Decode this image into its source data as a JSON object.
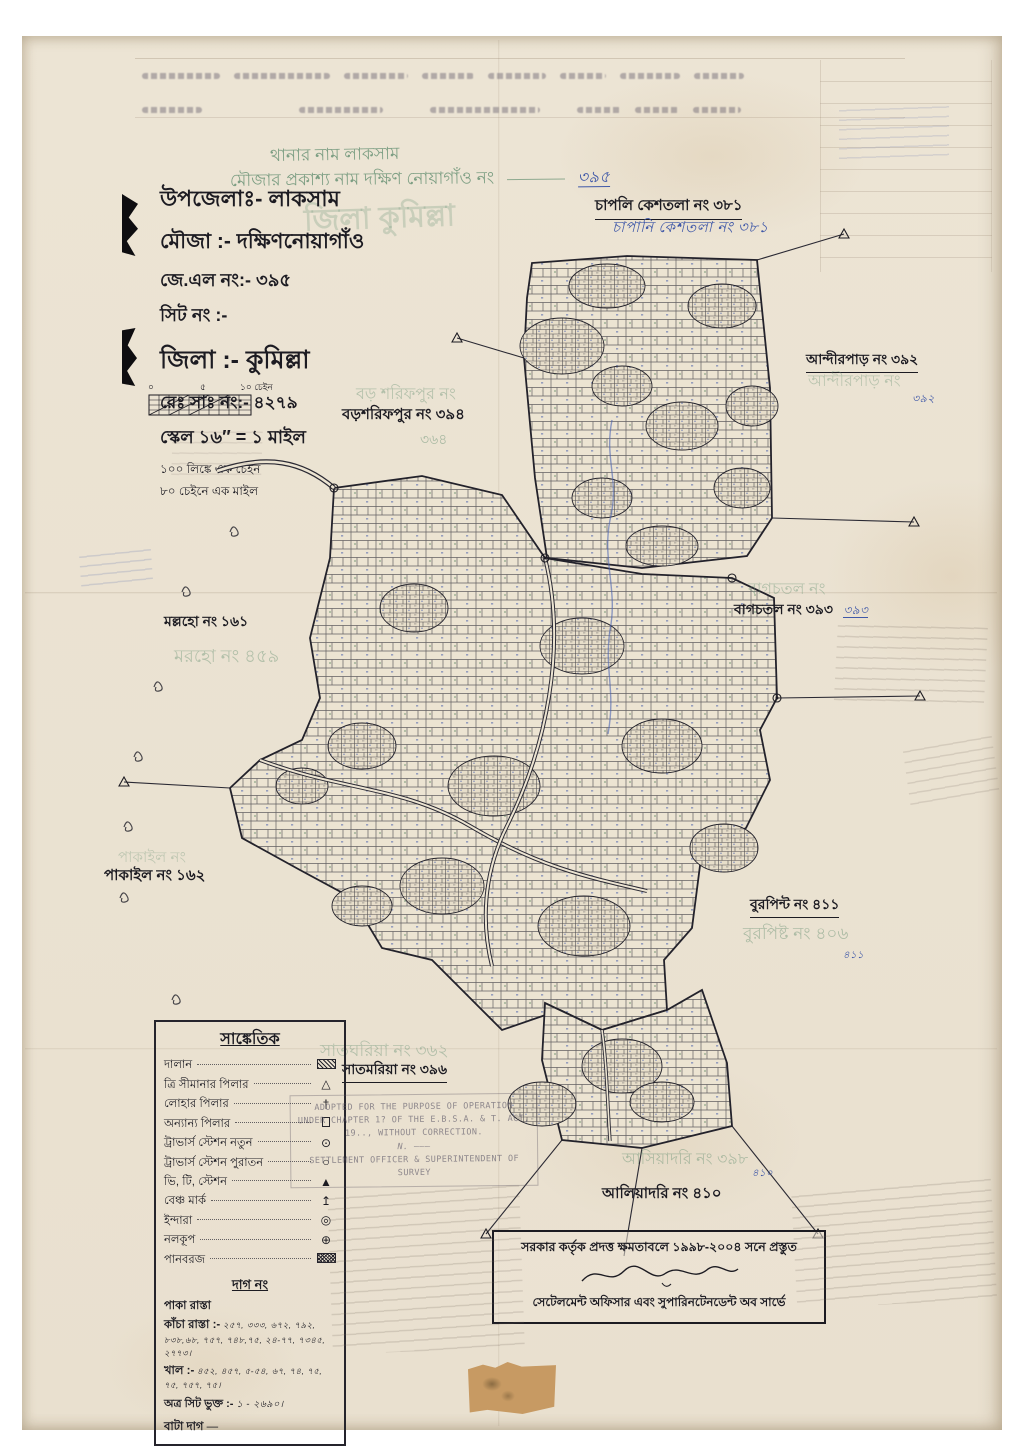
{
  "colors": {
    "ink": "#1c1b22",
    "pencil_green": "#689274",
    "pen_blue": "#3f58a8",
    "paper": "#ece4d4"
  },
  "pencil_top": {
    "line1": "থানার নাম  লাকসাম",
    "line2": "মৌজার প্রকাশ্য নাম  দক্ষিণ নোয়াগাঁও  নং",
    "number": "৩৯৫",
    "ghost": "জিলা  কুমিল্লা"
  },
  "header": {
    "upazila": "উপজেলাঃ- লাকসাম",
    "mouza": "মৌজা :- দক্ষিণনোয়াগাঁও",
    "jl_no": "জে.এল নং:- ৩৯৫",
    "sheet_no": "সিট নং :-",
    "zila": "জিলা :- কুমিল্লা",
    "reg_no": "রেঃ সাঃ নং:- ৪২৭৯",
    "scale": "স্কেল ১৬″ = ১ মাইল",
    "note1": "১০০ লিঙ্কে এক চেইন",
    "note2": "৮০ চেইনে এক মাইল",
    "scalebar": {
      "t0": "০",
      "t5": "৫",
      "t10": "১০ চেইন"
    }
  },
  "regions": [
    {
      "ink": "চাপলি কেশতলা নং ৩৮১",
      "blue": "চাপানি কেশতলা নং  ৩৮১"
    },
    {
      "ink": "আন্দীরপাড় নং ৩৯২",
      "pencil": "আন্দীরপাড় নং",
      "blue": "৩৯২"
    },
    {
      "ink": "মল্লহো নং ১৬১",
      "pencil": "মরহো নং ৪৫৯"
    },
    {
      "pencil": "বাগচতল নং",
      "ink": "বাগচতল নং ৩৯৩",
      "blue": "৩৯৩"
    },
    {
      "pencil": "বড় শরিফপুর নং",
      "ink": "বড়শরিফপুর নং ৩৯৪",
      "pencil_num": "৩৬৪"
    },
    {
      "pencil": "পাকাইল নং",
      "ink": "পাকাইল নং ১৬২"
    },
    {
      "ink": "বুরপিন্ট নং ৪১১",
      "pencil": "বুরপিষ্ট নং ৪০৬",
      "blue": "৪১১"
    },
    {
      "pencil": "সাতঘরিয়া নং ৩৬২",
      "ink": "সাতমরিয়া নং ৩৯৬"
    },
    {
      "pencil": "আসিয়াদরি নং ৩৯৮",
      "blue": "৪১০",
      "ink": "আলিয়াদরি নং ৪১০"
    }
  ],
  "legend": {
    "title": "সাঙ্কেতিক",
    "items": [
      {
        "label": "দালান",
        "symbol": "building-hatch"
      },
      {
        "label": "ত্রি সীমানার পিলার",
        "symbol": "triangle-outline"
      },
      {
        "label": "লোহার পিলার",
        "symbol": "iron-pillar-cross"
      },
      {
        "label": "অন্যান্য পিলার",
        "symbol": "small-square"
      },
      {
        "label": "ট্রাভার্স স্টেশন নতুন",
        "symbol": "circle-dot"
      },
      {
        "label": "ট্রাভার্স স্টেশন পুরাতন",
        "symbol": "circle-open"
      },
      {
        "label": "ভি, টি, স্টেশন",
        "symbol": "triangle-filled"
      },
      {
        "label": "বেঞ্চ মার্ক",
        "symbol": "benchmark-arrow"
      },
      {
        "label": "ইন্দারা",
        "symbol": "double-circle"
      },
      {
        "label": "নলকূপ",
        "symbol": "circle-plus"
      },
      {
        "label": "পানবরজ",
        "symbol": "crosshatch-rect"
      }
    ],
    "glyphs": {
      "triangle-outline": "△",
      "iron-pillar-cross": "†",
      "circle-dot": "⊙",
      "circle-open": "○",
      "triangle-filled": "▲",
      "benchmark-arrow": "↥",
      "double-circle": "◎",
      "circle-plus": "⊕"
    },
    "dag_heading": "দাগ নং",
    "dag_rows": [
      {
        "label": "পাকা রাস্তা",
        "value": ""
      },
      {
        "label": "কাঁচা রাস্তা :-",
        "value": "২৫৭, ৩৩৩, ৬৭২, ৭৯২, ৮৩৮,৬৮, ৭৫৭, ৭৪৮,৭৫, ২৪-৭৭, ৭৩৪৫, ২৭৭৩।"
      },
      {
        "label": "খাল :-",
        "value": "৪৫২, ৪৫৭, ৫-৫৪, ৬৭, ৭৪, ৭৫, ৭৫, ৭৫৭, ৭৫।"
      },
      {
        "label": "অত্র সিট ভুক্ত :-",
        "value": "১ - ২৬৯০।"
      },
      {
        "label": "বাটা দাগ",
        "value": "—"
      }
    ]
  },
  "stamp_en": {
    "l1": "ADOPTED FOR THE PURPOSE OF OPERATION",
    "l2": "UNDER CHAPTER 1? OF THE E.B.S.A. & T. ACT,",
    "l3": "19.., WITHOUT CORRECTION.",
    "l4": "N. ———",
    "l5": "SETTLEMENT OFFICER & SUPERINTENDENT OF",
    "l6": "SURVEY"
  },
  "stamp_bn": {
    "l1": "সরকার কর্তৃক প্রদত্ত ক্ষমতাবলে ১৯৯৮-২০০৪ সনে প্রস্তুত",
    "l2": "সেটেলমেন্ট অফিসার এবং সুপারিনটেনডেন্ট অব সার্ভে"
  }
}
